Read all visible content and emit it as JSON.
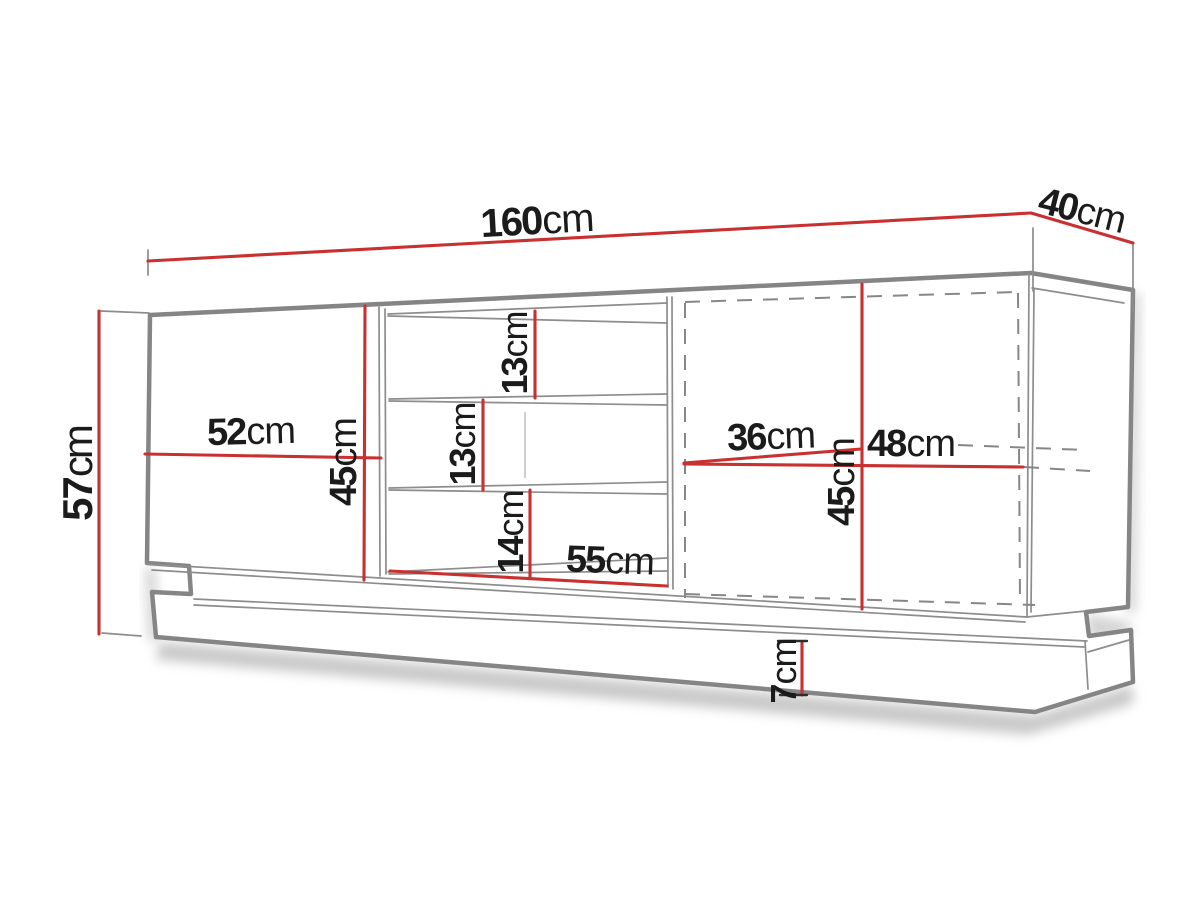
{
  "diagram": {
    "kind": "furniture dimension drawing",
    "subject": "TV stand / sideboard with two doors, open middle shelves and plinth",
    "unit": "cm"
  },
  "colors": {
    "dimension_line_red": "#c93030",
    "outline_gray": "#858585",
    "inner_line_gray": "#8d8d8d",
    "text_black": "#1b1b1b",
    "background": "#ffffff"
  },
  "dimensions": [
    {
      "id": "total-width",
      "value": "160",
      "unit": "cm"
    },
    {
      "id": "depth",
      "value": "40",
      "unit": "cm"
    },
    {
      "id": "total-height",
      "value": "57",
      "unit": "cm"
    },
    {
      "id": "left-door-width",
      "value": "52",
      "unit": "cm"
    },
    {
      "id": "left-door-height",
      "value": "45",
      "unit": "cm"
    },
    {
      "id": "niche-top-height",
      "value": "13",
      "unit": "cm"
    },
    {
      "id": "niche-middle-height",
      "value": "13",
      "unit": "cm"
    },
    {
      "id": "niche-bottom-height",
      "value": "14",
      "unit": "cm"
    },
    {
      "id": "niche-width",
      "value": "55",
      "unit": "cm"
    },
    {
      "id": "right-inner-width",
      "value": "36",
      "unit": "cm"
    },
    {
      "id": "right-door-width",
      "value": "48",
      "unit": "cm"
    },
    {
      "id": "right-door-height",
      "value": "45",
      "unit": "cm"
    },
    {
      "id": "plinth-height",
      "value": "7",
      "unit": "cm"
    }
  ]
}
